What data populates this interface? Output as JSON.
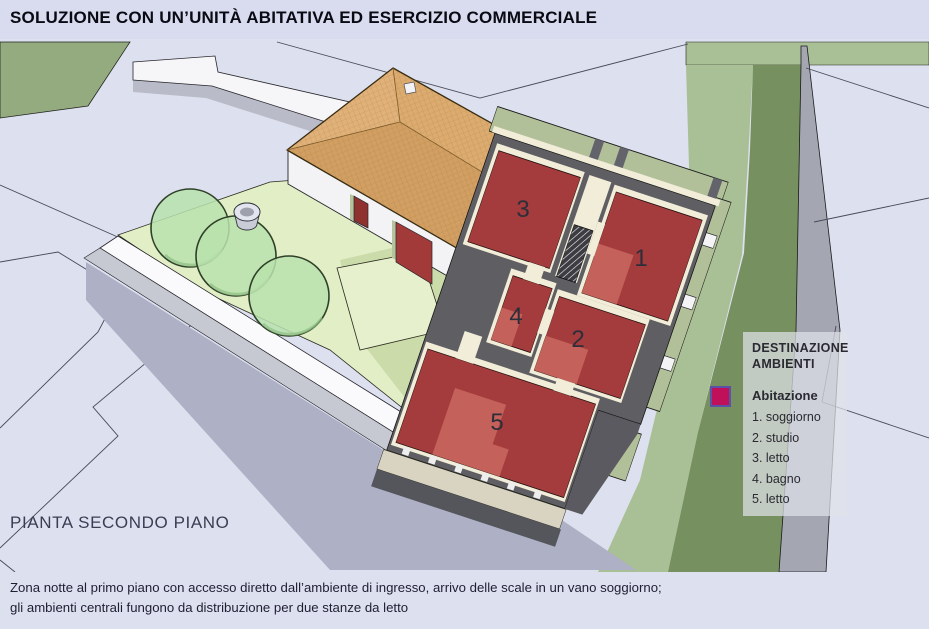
{
  "header": {
    "title": "SOLUZIONE CON UN’UNITÀ ABITATIVA ED ESERCIZIO COMMERCIALE"
  },
  "plan": {
    "caption_label": "PIANTA SECONDO PIANO",
    "room_numbers": [
      "1",
      "2",
      "3",
      "4",
      "5"
    ]
  },
  "legend": {
    "title": "DESTINAZIONE AMBIENTI",
    "group": "Abitazione",
    "swatch_color": "#c0105a",
    "items": [
      "1. soggiorno",
      "2. studio",
      "3. letto",
      "4. bagno",
      "5. letto"
    ]
  },
  "footer": {
    "line1": "Zona notte al primo piano con accesso diretto dall’ambiente di ingresso, arrivo delle scale in un vano soggiorno;",
    "line2": "gli ambienti centrali fungono da distribuzione per due stanze da letto"
  },
  "colors": {
    "background_lavender": "#dde0ee",
    "accent_magenta": "#c0105a",
    "floor_red": "#a43b3c",
    "floor_red_light": "#c4615a",
    "wall_gray": "#5f5f63",
    "wall_cream": "#f1edd8",
    "exterior_green_wall": "#b2c09a",
    "roof_tan": "#d5a266",
    "terrain_green_light": "#a9bf95",
    "terrain_green_dark": "#77905f"
  }
}
